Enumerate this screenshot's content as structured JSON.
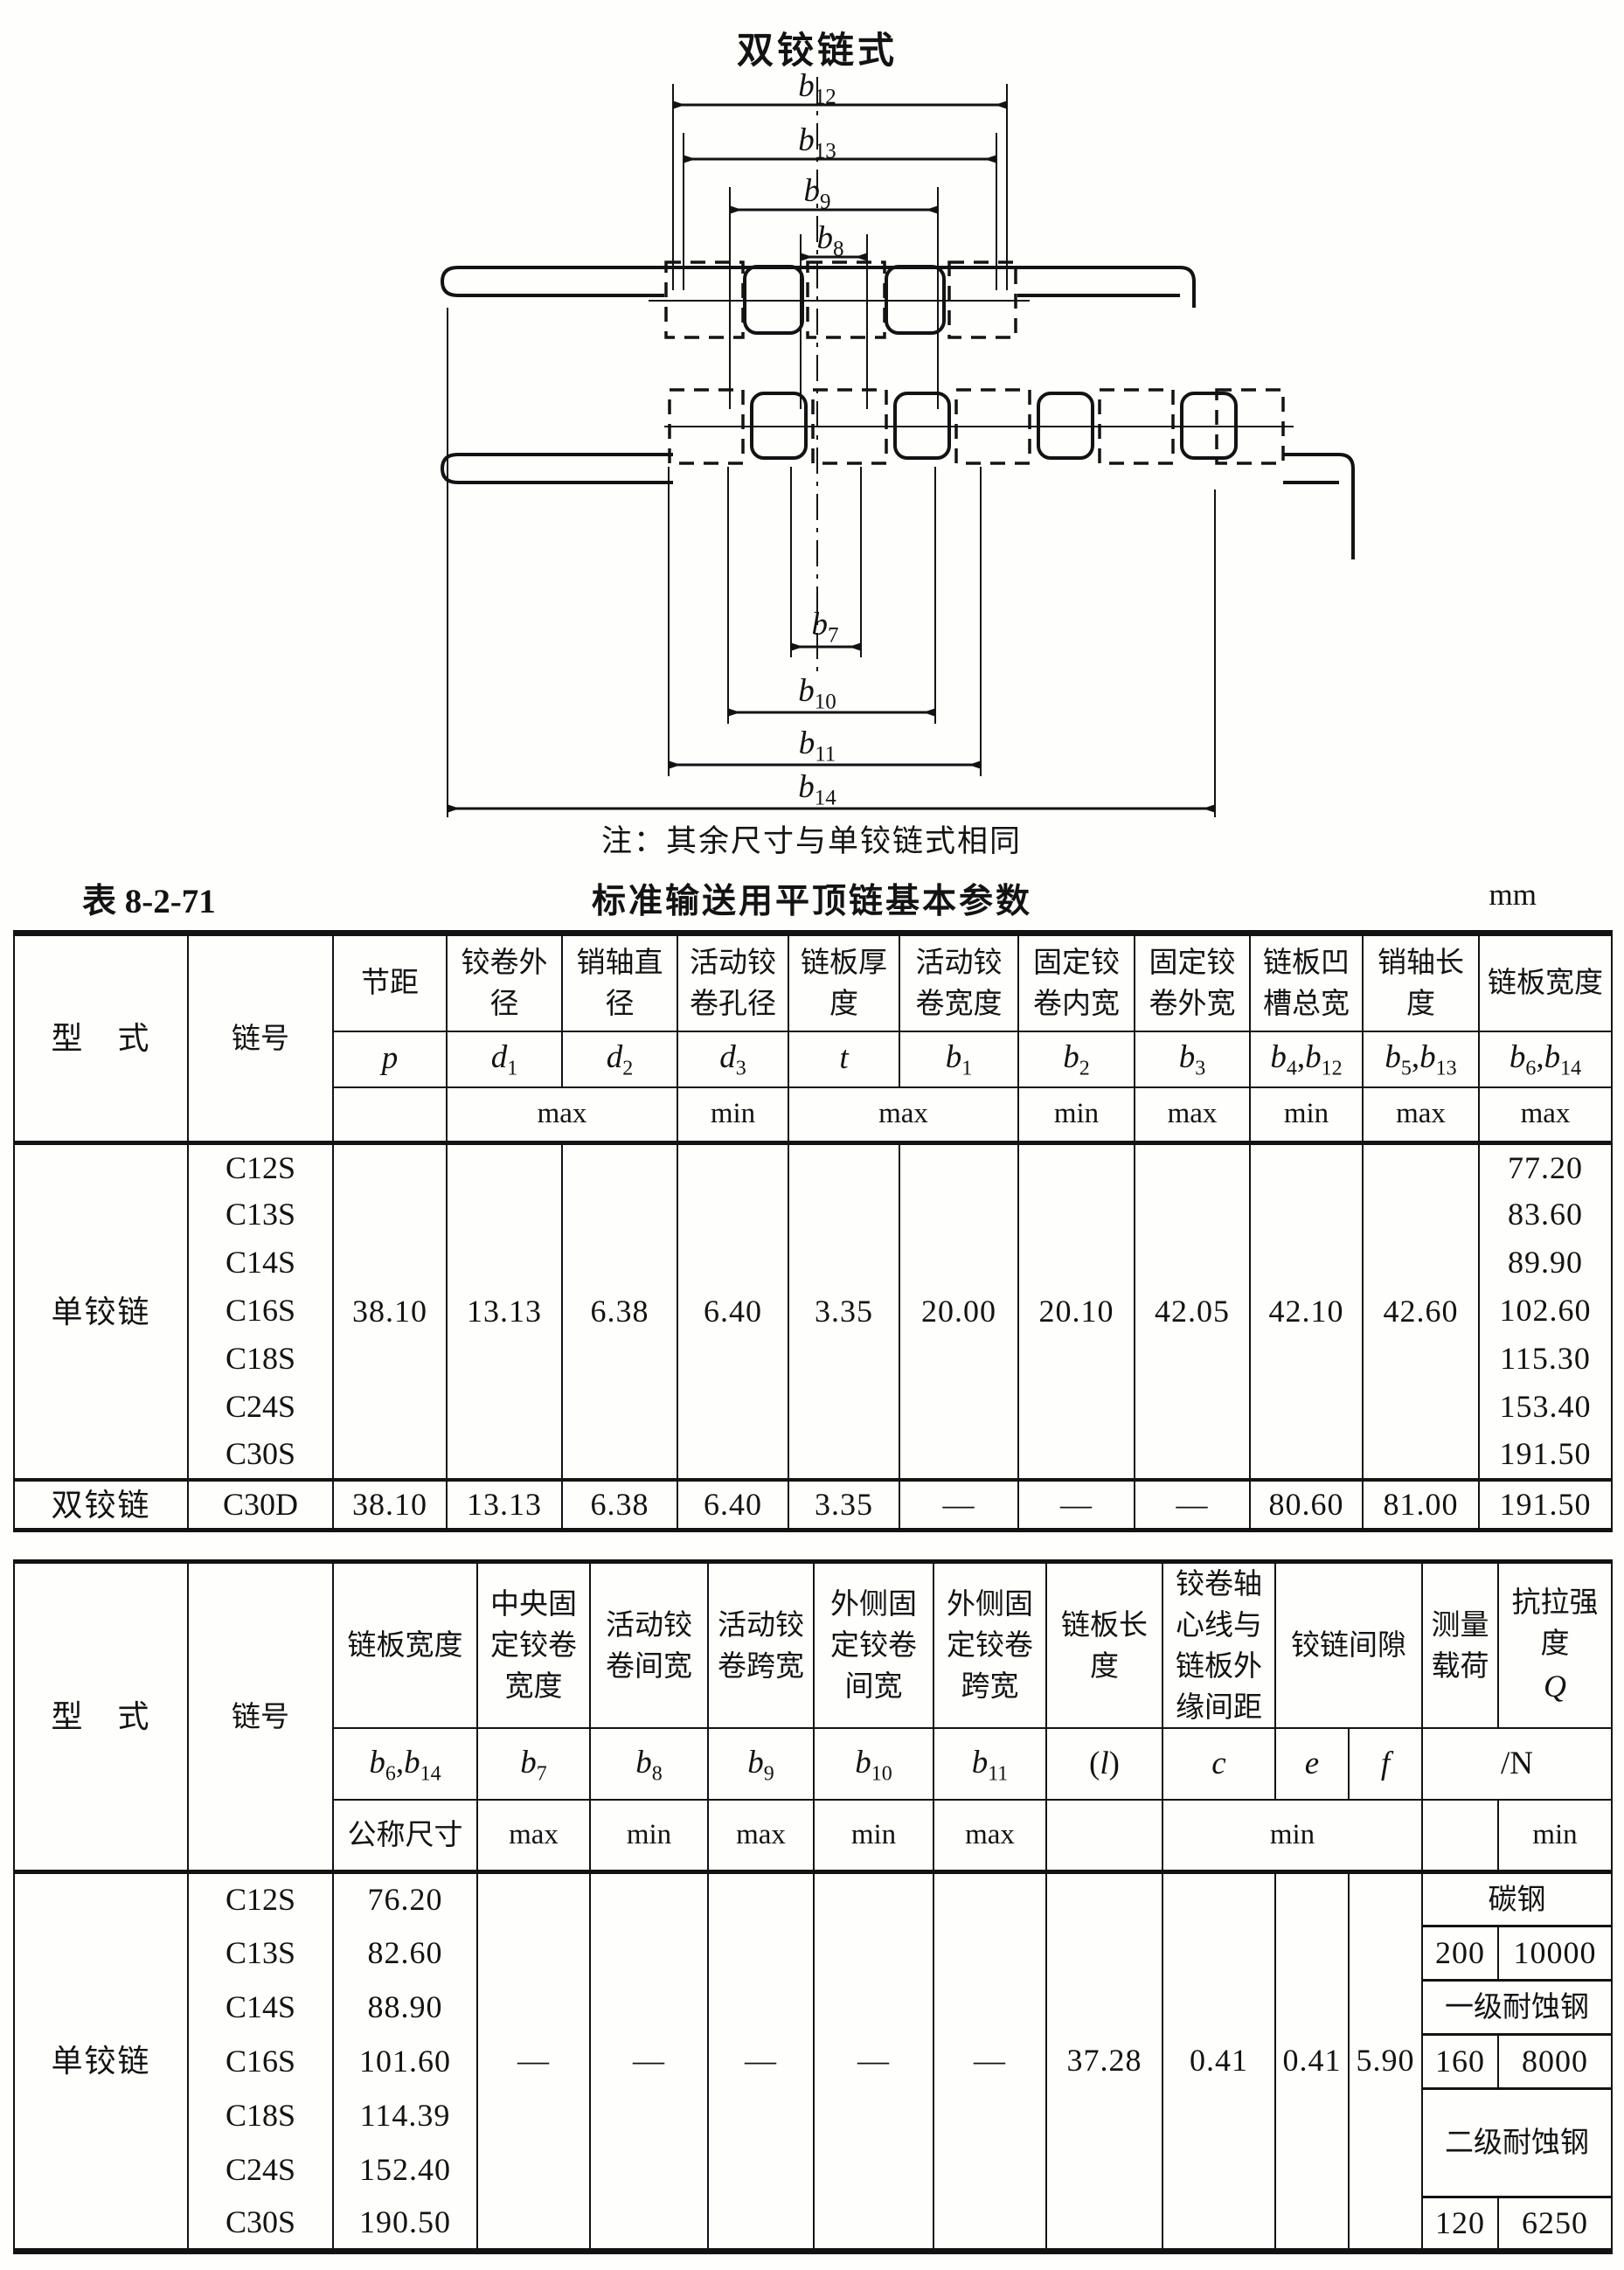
{
  "diagram": {
    "title": "双铰链式",
    "note": "注：其余尺寸与单铰链式相同",
    "dims": {
      "b12": {
        "m": "b",
        "s": "12"
      },
      "b13": {
        "m": "b",
        "s": "13"
      },
      "b9": {
        "m": "b",
        "s": "9"
      },
      "b8": {
        "m": "b",
        "s": "8"
      },
      "b7": {
        "m": "b",
        "s": "7"
      },
      "b10": {
        "m": "b",
        "s": "10"
      },
      "b11": {
        "m": "b",
        "s": "11"
      },
      "b14": {
        "m": "b",
        "s": "14"
      }
    }
  },
  "caption": {
    "label": "表 8-2-71",
    "title": "标准输送用平顶链基本参数",
    "unit": "mm"
  },
  "table1": {
    "type_head": "型　式",
    "no_head": "链号",
    "heads": [
      "节距",
      "铰卷外径",
      "销轴直径",
      "活动铰卷孔径",
      "链板厚度",
      "活动铰卷宽度",
      "固定铰卷内宽",
      "固定铰卷外宽",
      "链板凹槽总宽",
      "销轴长度",
      "链板宽度"
    ],
    "sym": {
      "p": {
        "m": "p"
      },
      "d1": {
        "m": "d",
        "s": "1"
      },
      "d2": {
        "m": "d",
        "s": "2"
      },
      "d3": {
        "m": "d",
        "s": "3"
      },
      "t": {
        "m": "t"
      },
      "b1": {
        "m": "b",
        "s": "1"
      },
      "b2": {
        "m": "b",
        "s": "2"
      },
      "b3": {
        "m": "b",
        "s": "3"
      },
      "b4b12": {
        "m1": "b",
        "s1": "4",
        "sep": ",",
        "m2": "b",
        "s2": "12"
      },
      "b5b13": {
        "m1": "b",
        "s1": "5",
        "sep": ",",
        "m2": "b",
        "s2": "13"
      },
      "b6b14": {
        "m1": "b",
        "s1": "6",
        "sep": ",",
        "m2": "b",
        "s2": "14"
      }
    },
    "limits": {
      "dmax": "max",
      "d3min": "min",
      "tmax": "max",
      "b2min": "min",
      "b3max": "max",
      "b4min": "min",
      "b5max": "max",
      "b6max": "max"
    },
    "single": {
      "type": "单铰链",
      "p": "38.10",
      "d1": "13.13",
      "d2": "6.38",
      "d3": "6.40",
      "t": "3.35",
      "b1": "20.00",
      "b2": "20.10",
      "b3": "42.05",
      "b4b12": "42.10",
      "b5b13": "42.60",
      "rows": [
        {
          "no": "C12S",
          "w": "77.20"
        },
        {
          "no": "C13S",
          "w": "83.60"
        },
        {
          "no": "C14S",
          "w": "89.90"
        },
        {
          "no": "C16S",
          "w": "102.60"
        },
        {
          "no": "C18S",
          "w": "115.30"
        },
        {
          "no": "C24S",
          "w": "153.40"
        },
        {
          "no": "C30S",
          "w": "191.50"
        }
      ]
    },
    "double": {
      "type": "双铰链",
      "no": "C30D",
      "p": "38.10",
      "d1": "13.13",
      "d2": "6.38",
      "d3": "6.40",
      "t": "3.35",
      "b1": "—",
      "b2": "—",
      "b3": "—",
      "b4b12": "80.60",
      "b5b13": "81.00",
      "b6b14": "191.50"
    }
  },
  "table2": {
    "type_head": "型　式",
    "no_head": "链号",
    "heads": [
      "链板宽度",
      "中央固定铰卷宽度",
      "活动铰卷间宽",
      "活动铰卷跨宽",
      "外侧固定铰卷间宽",
      "外侧固定铰卷跨宽",
      "链板长度",
      "铰卷轴心线与链板外缘间距",
      "铰链间隙",
      "测量载荷",
      "抗拉强度"
    ],
    "q": "Q",
    "sym": {
      "b6b14": {
        "m1": "b",
        "s1": "6",
        "sep": ",",
        "m2": "b",
        "s2": "14"
      },
      "b7": {
        "m": "b",
        "s": "7"
      },
      "b8": {
        "m": "b",
        "s": "8"
      },
      "b9": {
        "m": "b",
        "s": "9"
      },
      "b10": {
        "m": "b",
        "s": "10"
      },
      "b11": {
        "m": "b",
        "s": "11"
      },
      "l": {
        "pre": "(",
        "m": "l",
        "post": ")"
      },
      "c": {
        "m": "c"
      },
      "e": {
        "m": "e"
      },
      "f": {
        "m": "f"
      },
      "n": "/N"
    },
    "limits": {
      "nominal": "公称尺寸",
      "b7max": "max",
      "b8min": "min",
      "b9max": "max",
      "b10min": "min",
      "b11max": "max",
      "cefmin": "min",
      "qmin": "min"
    },
    "single": {
      "type": "单铰链",
      "b7": "—",
      "b8": "—",
      "b9": "—",
      "b10": "—",
      "b11": "—",
      "l": "37.28",
      "c": "0.41",
      "e": "0.41",
      "f": "5.90",
      "rows": [
        {
          "no": "C12S",
          "w": "76.20"
        },
        {
          "no": "C13S",
          "w": "82.60"
        },
        {
          "no": "C14S",
          "w": "88.90"
        },
        {
          "no": "C16S",
          "w": "101.60"
        },
        {
          "no": "C18S",
          "w": "114.39"
        },
        {
          "no": "C24S",
          "w": "152.40"
        },
        {
          "no": "C30S",
          "w": "190.50"
        }
      ],
      "strength": {
        "steel1": "碳钢",
        "load1": "200",
        "q1": "10000",
        "steel2": "一级耐蚀钢",
        "load2": "160",
        "q2": "8000",
        "steel3": "二级耐蚀钢",
        "load3": "120",
        "q3": "6250"
      }
    }
  }
}
